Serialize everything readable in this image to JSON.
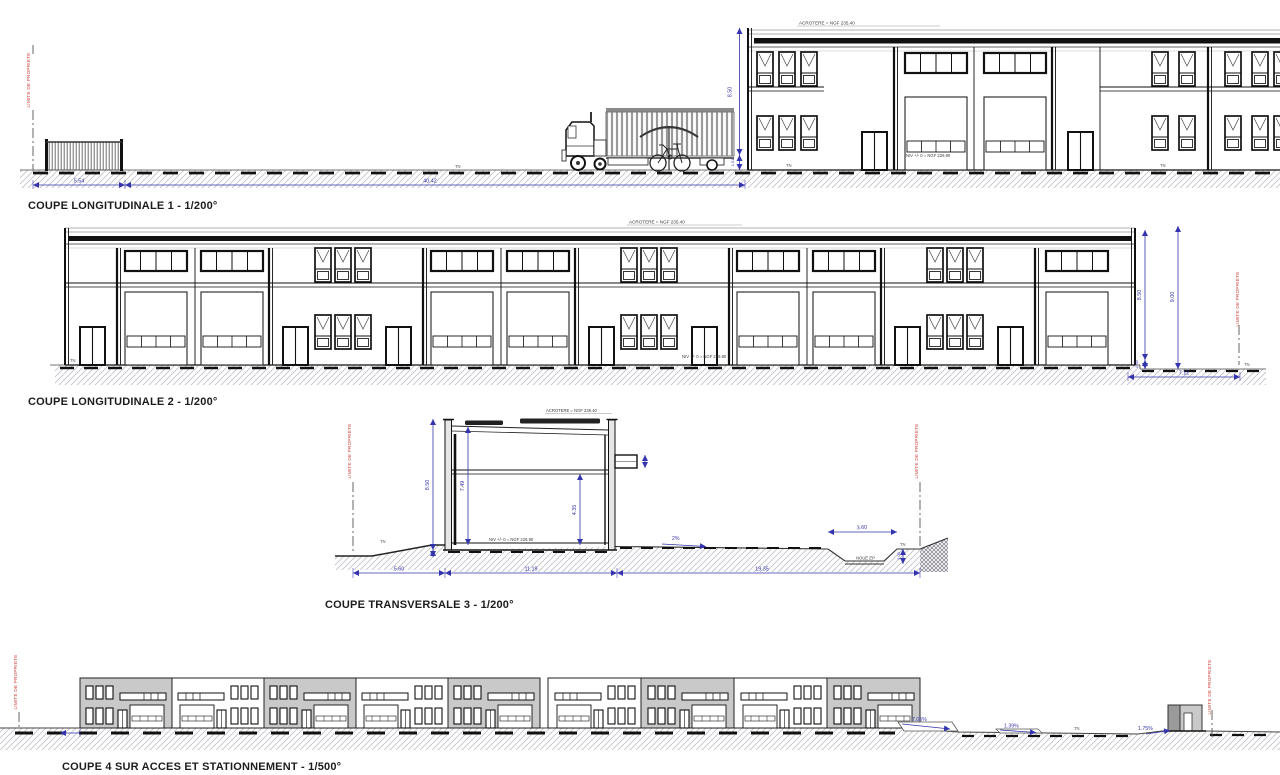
{
  "titles": {
    "c1": "COUPE LONGITUDINALE 1 - 1/200°",
    "c2": "COUPE LONGITUDINALE 2 - 1/200°",
    "c3": "COUPE TRANSVERSALE 3 - 1/200°",
    "c4": "COUPE 4 SUR ACCES ET STATIONNEMENT - 1/500°"
  },
  "labels": {
    "limite": "LIMITE DE PROPRIETE",
    "acrotere": "ACROTERE = NGF 235.40",
    "niveau": "NIV +/- 0 = NGF 226.90",
    "tn": "TN",
    "noue": "NOUE EP"
  },
  "coupe1": {
    "fence_width": "5.54",
    "yard_width": "40.42",
    "building_height": "8.50",
    "tn_offset": "1.01"
  },
  "coupe2": {
    "building_height": "8.50",
    "total_height": "9.00",
    "tn_offset": "0.50",
    "right_setback": "7.12"
  },
  "coupe3": {
    "building_height": "8.50",
    "interior_height": "7.49",
    "mezzanine_height": "4.35",
    "left_setback": "5.60",
    "building_width": "11.19",
    "right_width": "19.35",
    "noue_width": "3.60",
    "noue_depth": "1.00",
    "slope": "2%"
  },
  "coupe4": {
    "slope1": "7.05%",
    "slope2": "1.39%",
    "slope3": "1.75%"
  },
  "colors": {
    "dim_blue": "#3434ad",
    "limit_red": "#cc3b35",
    "ink": "#1a1a1a",
    "module_gray": "#c9c9c9",
    "ground_hatch": "#c2c2ca"
  }
}
